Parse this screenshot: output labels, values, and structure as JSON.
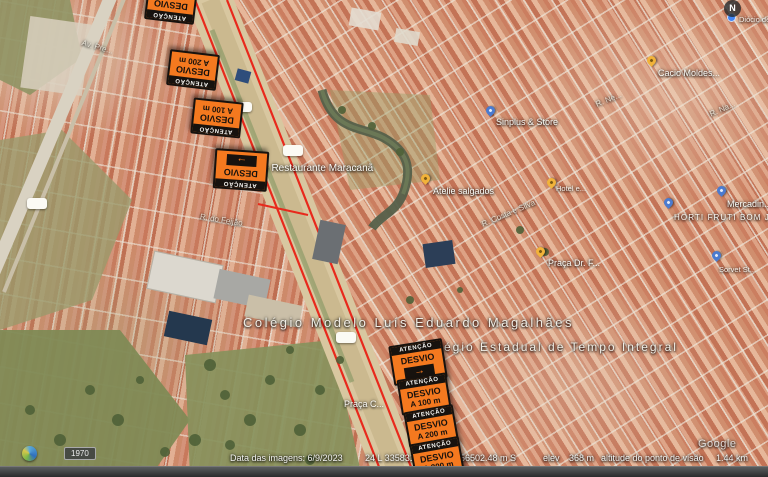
{
  "window": {
    "compass_label": "N",
    "time_badge": "1970",
    "watermark": "Google"
  },
  "status_bar": {
    "imagery_date": "Data das imagens: 6/9/2023",
    "utm_zone_easting": "24 L 335831.3",
    "utm_southing": "56502.48 m S",
    "elev_label": "elev",
    "elev_value": "368 m",
    "eye_alt_label": "altitude do ponto de visão",
    "eye_alt_value": "1.44 km"
  },
  "signs": {
    "band_text": "ATENÇÃO",
    "title": "DESVIO",
    "arrow_glyph": "→",
    "colors": {
      "orange": "#F4791F",
      "black": "#17120E"
    },
    "top_cluster": [
      {
        "distance": "A 300 m"
      },
      {
        "distance": "A 200 m"
      },
      {
        "distance": "A 100 m"
      },
      {
        "distance": "",
        "has_arrow": true
      }
    ],
    "bottom_cluster": [
      {
        "distance": "",
        "has_arrow": true
      },
      {
        "distance": "A 100 m"
      },
      {
        "distance": "A 200 m"
      },
      {
        "distance": "A 300 m"
      }
    ]
  },
  "map_labels": {
    "hotel_restaurante": "Hotel e Restaurante Maracanã",
    "atelie": "Atelie salgados",
    "hotel_small": "Hotel e...",
    "colegio_modelo": "Colégio Modelo Luís Eduardo Magalhães",
    "colegio_estadual": "Colégio Estadual de Tempo Integral",
    "praca_dr": "Praça Dr. F...",
    "praca_c": "Praça C...",
    "cacio": "Cacio Moldes...",
    "sinplus": "Sinplus & Store",
    "hortifruti": "HORTI FRUTI BOM JE...",
    "mercadinho": "Mercadin...",
    "sorvet": "Sorvet St...",
    "diocio": "Diócio de Tecid...",
    "streets": {
      "feijao": "R. do Feijão",
      "costa": "R. Costa e Silva",
      "ave": "Av. Pre...",
      "ne": "R. Ne...",
      "na": "R. Na..."
    }
  },
  "route": {
    "color": "#E8291C"
  }
}
